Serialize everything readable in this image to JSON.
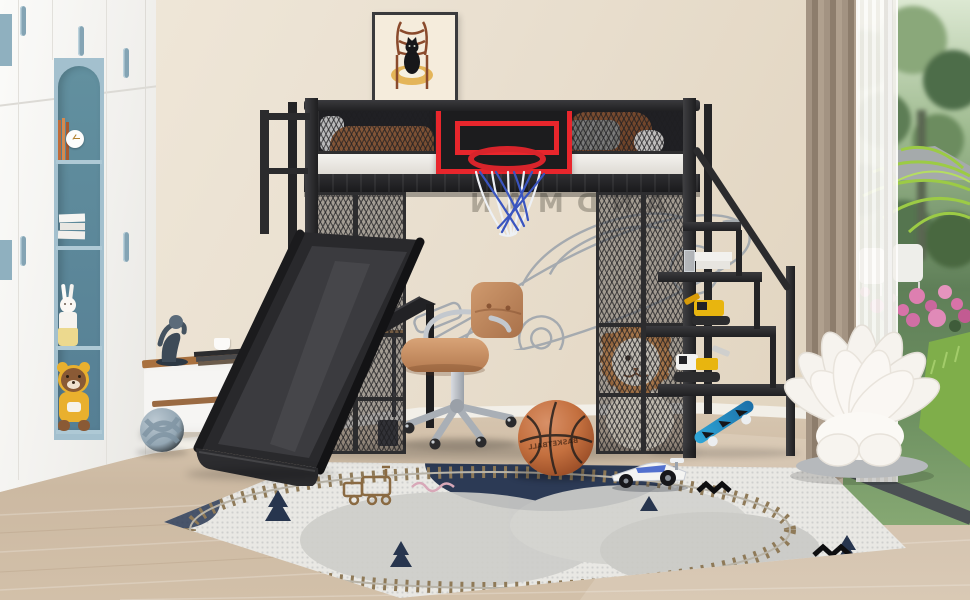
{
  "scene": {
    "type": "product-photo",
    "description": "Kids bedroom with black metal loft bed featuring basketball hoop, slide, under-bed desk and storage staircase",
    "wall_decal": {
      "text": "SANDMAN",
      "mirrored": true
    },
    "basketball_label": "BASKETBALL"
  },
  "palette": {
    "wall_beige": "#e9dfd0",
    "wardrobe_white": "#f7f6f3",
    "accent_blue": "#84a4b4",
    "niche_blue": "#5d8ba1",
    "bed_frame_black": "#2a2a2c",
    "backboard_red": "#e8262c",
    "net_blue": "#3a55c0",
    "chair_tan": "#c28a5f",
    "floor_wood": "#cdbba5",
    "rug_gray": "#e9e8e4",
    "rug_navy": "#2c3a55",
    "toy_yellow": "#e8b50f",
    "skateboard_blue": "#2fa7d8",
    "curtain_brown": "#9a8a7a",
    "garden_green": "#6f8f63",
    "petal_chair_white": "#f7f4ef"
  },
  "objects": [
    "wardrobe-with-blue-handles",
    "arched-niche-shelf",
    "alarm-clock",
    "books",
    "rabbit-doll",
    "teddy-bear",
    "tv-stand",
    "figurine-sculpture",
    "book-stack",
    "cup",
    "knot-ball-pillow",
    "cat-on-chair-picture",
    "loft-bed",
    "guard-rail-mesh",
    "mattress",
    "pillows",
    "blanket",
    "basketball-backboard",
    "basketball-rim",
    "hoop-net",
    "slide",
    "slide-rail",
    "desk",
    "desk-lamp",
    "laptop",
    "office-chair",
    "storage-staircase",
    "handrail",
    "excavator-toy",
    "white-books",
    "lion-plush",
    "skateboard",
    "basketball",
    "race-car-toy",
    "play-rug",
    "petal-lounge-chair",
    "window",
    "curtain",
    "sheer-curtain",
    "garden",
    "pink-flowers",
    "patio-chairs",
    "lawn"
  ]
}
